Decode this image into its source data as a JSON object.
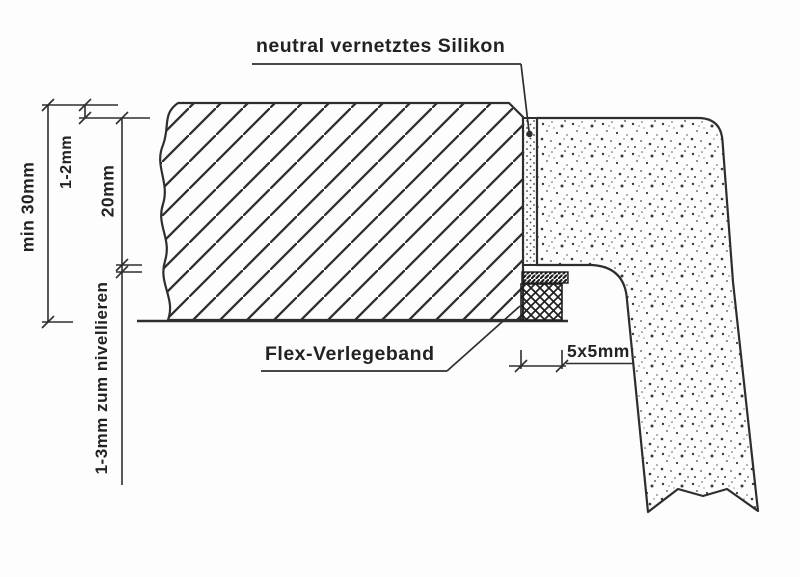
{
  "drawing": {
    "title_note": "neutral vernetztes Silikon",
    "labels": {
      "silicone": "neutral vernetztes Silikon",
      "flex_tape": "Flex-Verlegeband"
    },
    "dimensions": {
      "total_thickness": "min 30mm",
      "top_protrusion": "1-2mm",
      "panel_thickness": "20mm",
      "leveling_gap": "1-3mm zum nivellieren",
      "tape_size": "5x5mm"
    },
    "colors": {
      "ink": "#2e2e2e",
      "paper": "#fdfdfd"
    }
  }
}
